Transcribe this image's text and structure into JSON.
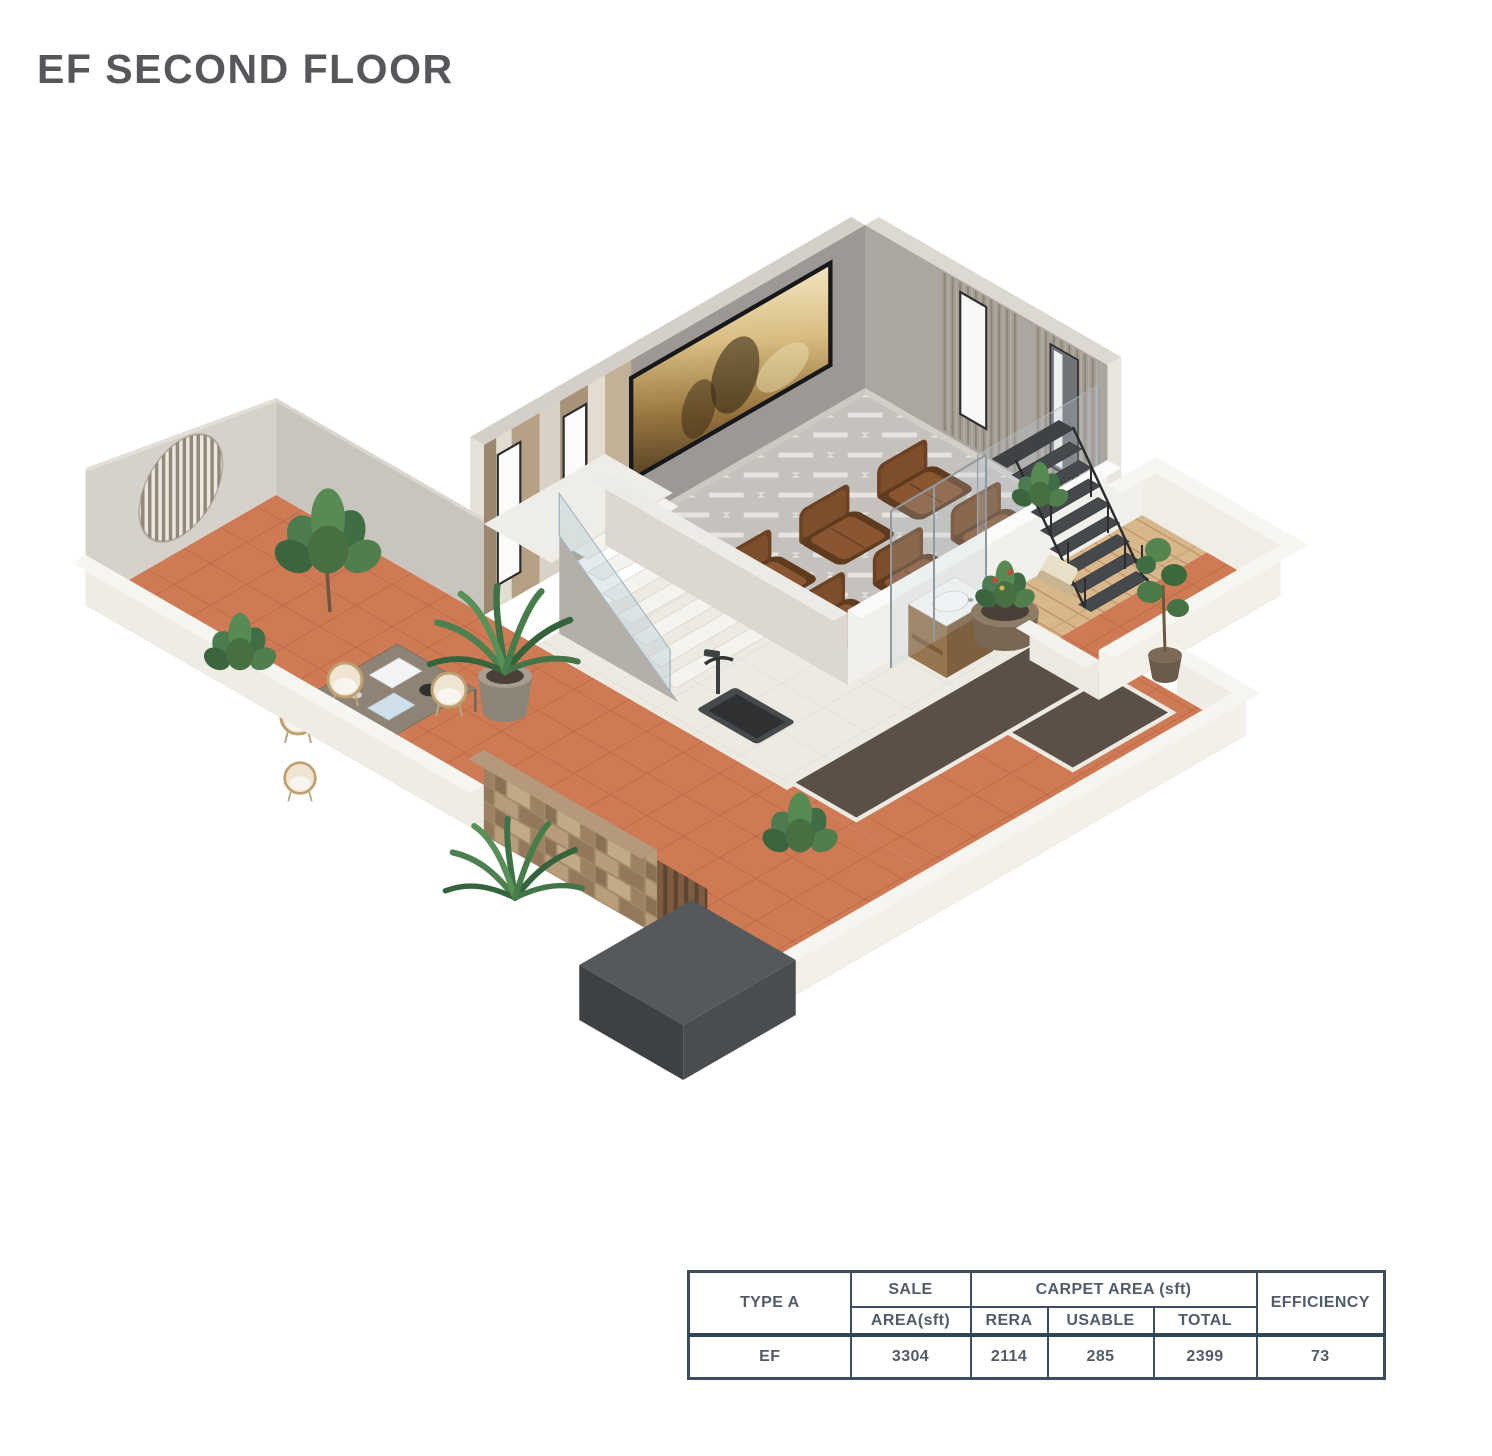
{
  "page": {
    "title": "EF SECOND FLOOR",
    "background": "#ffffff"
  },
  "palette": {
    "terracotta": "#cd7a55",
    "wall_gray": "#a39e98",
    "accent_wood": "#b5a085",
    "recliner_brown": "#8a5531",
    "table_border": "#3e4e5e"
  },
  "table": {
    "type_header": "TYPE A",
    "sale_header_top": "SALE",
    "sale_header_bottom": "AREA(sft)",
    "carpet_group_header": "CARPET AREA (sft)",
    "carpet_sub_headers": [
      "RERA",
      "USABLE",
      "TOTAL"
    ],
    "efficiency_header": "EFFICIENCY",
    "rows": [
      {
        "type": "EF",
        "sale_area": "3304",
        "rera": "2114",
        "usable": "285",
        "total": "2399",
        "efficiency": "73"
      }
    ]
  }
}
